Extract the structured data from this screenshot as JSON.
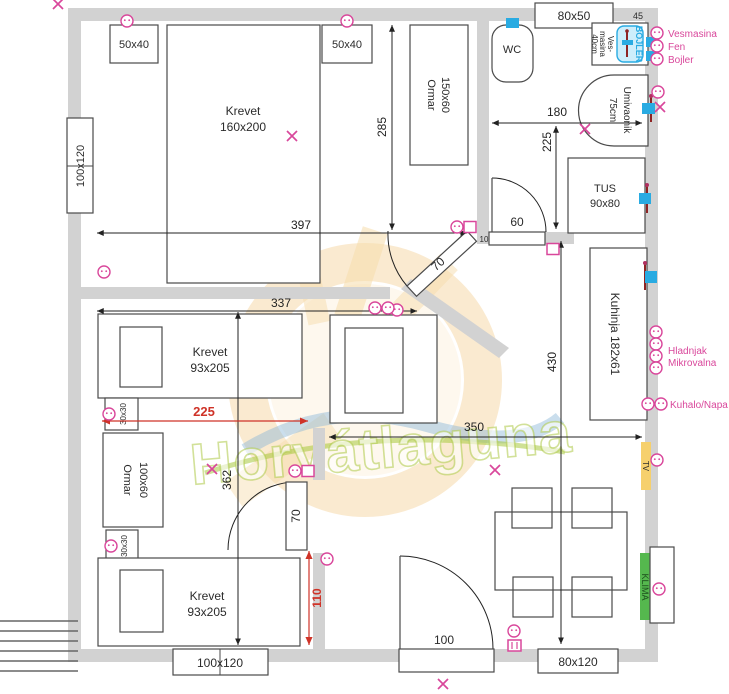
{
  "watermark": {
    "brand": "Horvátlaguna"
  },
  "colors": {
    "wall": "#d2d2d2",
    "furniture_line": "#4a4a4a",
    "dimension": "#222222",
    "pink_symbols": "#d9479b",
    "red_dimensions": "#cf3328",
    "plumbing_blue": "#29abe2",
    "faucet_maroon": "#8e2424",
    "tv_yellow": "#f6d06d",
    "klima_green": "#55b84e"
  },
  "windows": {
    "top": "80x50",
    "left": "100x120",
    "bottom_left": "100x120",
    "bottom_right": "80x120"
  },
  "doors": {
    "top_bedroom": "70",
    "lower_bedroom": "70",
    "bathroom": "60",
    "entry": "100"
  },
  "dims": {
    "bedroom_width": "397",
    "bedroom_height": "285",
    "bath_width": "180",
    "bath_height": "225",
    "wall_45": "45",
    "wall_10": "10",
    "room2_width": "337",
    "room2_height": "362",
    "living_height": "430",
    "living_width": "350",
    "red_width": "225",
    "red_height": "110"
  },
  "bath": {
    "wc": "WC",
    "washer": [
      "Ves-",
      "masina",
      "40cm"
    ],
    "boiler": "BOJLER",
    "sink": [
      "Umivaonik",
      "75cm"
    ],
    "shower": [
      "TUS",
      "90x80"
    ]
  },
  "bedroom1": {
    "bed": [
      "Krevet",
      "160x200"
    ],
    "nightstand_a": "50x40",
    "nightstand_b": "50x40",
    "wardrobe": [
      "Ormar",
      "150x60"
    ]
  },
  "bedroom2": {
    "bed_a": [
      "Krevet",
      "93x205"
    ],
    "bed_b": [
      "Krevet",
      "93x205"
    ],
    "nightstand_a": "30x30",
    "nightstand_b": "30x30",
    "wardrobe": [
      "Ormar",
      "100x60"
    ]
  },
  "kitchen": {
    "unit": "Kuhinja 182x61",
    "outlet_labels": [
      "Hladnjak",
      "Mikrovalna",
      "Kuhalo/Napa"
    ]
  },
  "living": {
    "tv": "TV",
    "ac": "KLIMA"
  },
  "utility_labels": [
    "Vesmasina",
    "Fen",
    "Bojler"
  ]
}
